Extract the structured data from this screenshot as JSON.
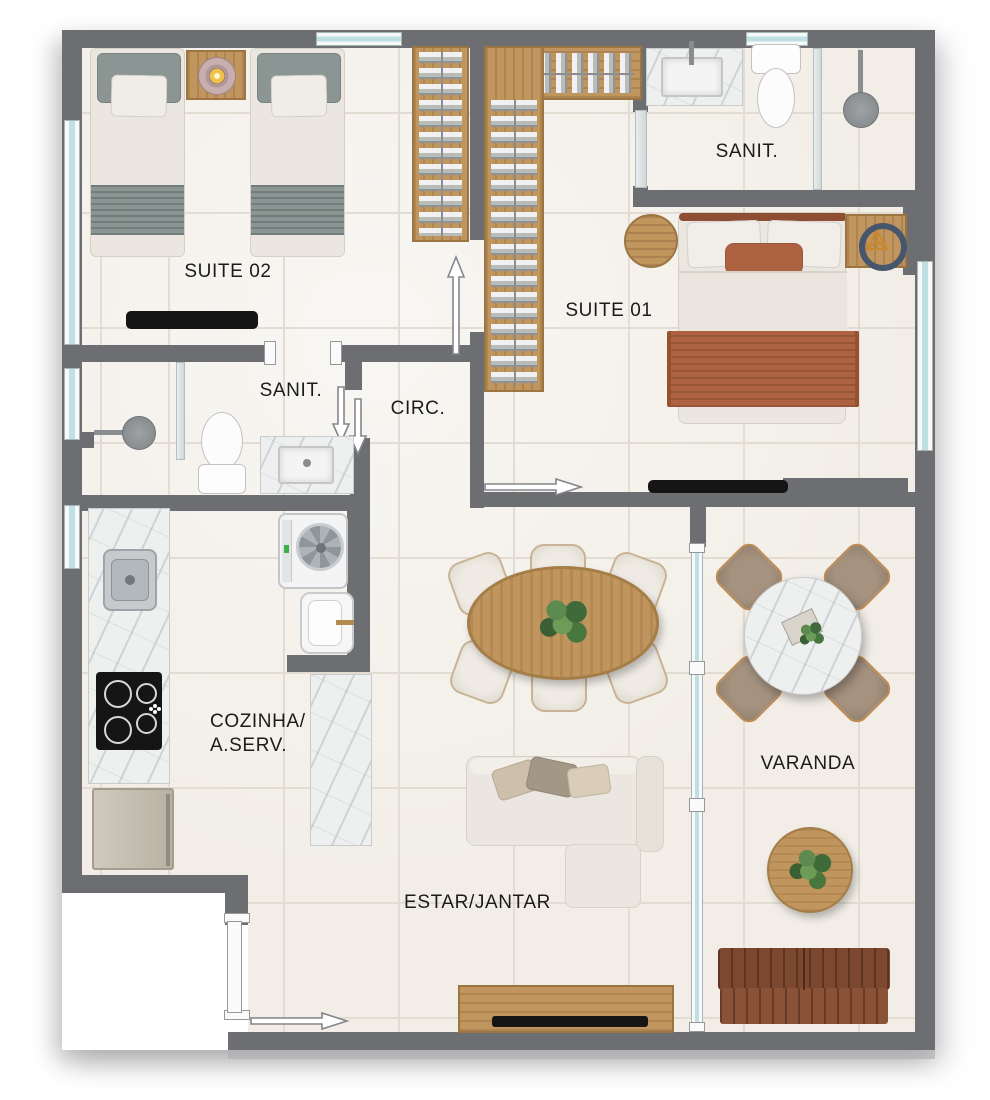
{
  "labels": {
    "suite02": "SUITE 02",
    "sanit02": "SANIT.",
    "circ": "CIRC.",
    "suite01": "SUITE 01",
    "sanit01": "SANIT.",
    "cozinha_line1": "COZINHA/",
    "cozinha_line2": "A.SERV.",
    "estar": "ESTAR/JANTAR",
    "varanda": "VARANDA"
  },
  "colors": {
    "wall": "#6d6e71",
    "floor": "#f2eee7",
    "grout": "#e2dcd2",
    "wood": "#c0955e",
    "wooddark": "#9b7642",
    "marble": "#eef0f0",
    "glass": "#bfdfe3",
    "fabric": "#ebe7e0",
    "sage": "#8b9593",
    "rust": "#ad6242",
    "rustdark": "#8d4e33",
    "leather": "#8a5338",
    "leatherdark": "#7c4930",
    "taupe": "#9b8a7a",
    "black": "#151515",
    "steel": "#c6cacd"
  }
}
